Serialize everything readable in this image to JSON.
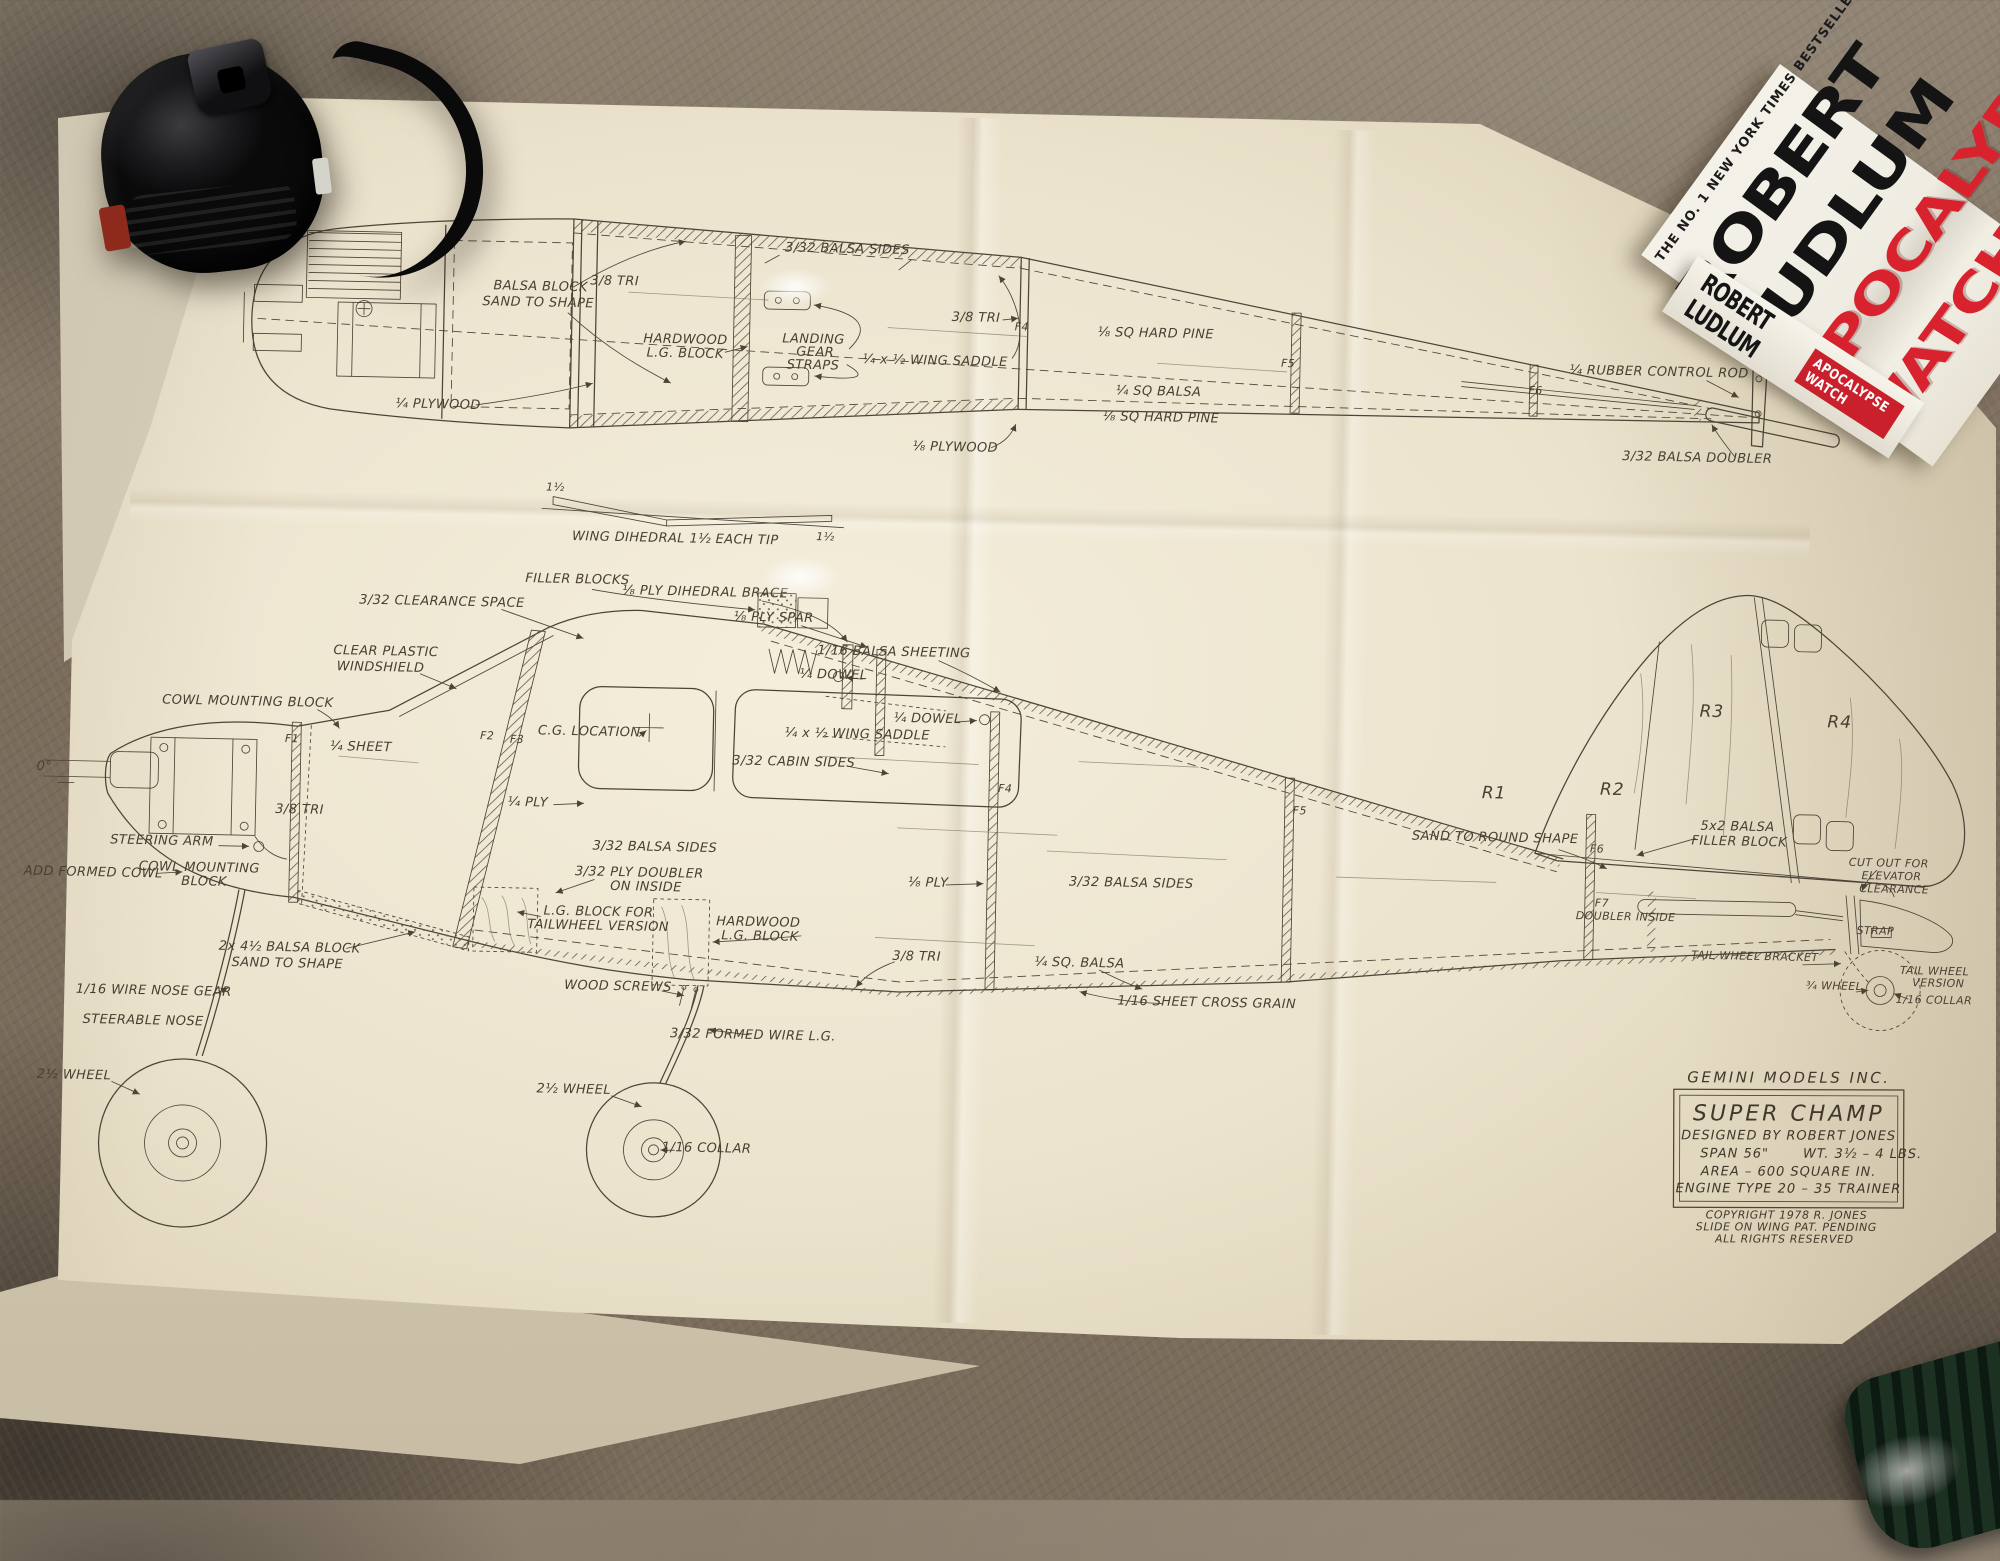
{
  "palette": {
    "carpet": "#7a6c5b",
    "paper": "#ece3cd",
    "ink": "#4d4437",
    "book_red": "#d8232f",
    "book_black": "#141414",
    "tape_black": "#111113",
    "green_object": "#16271c"
  },
  "book": {
    "banner": "THE NO. 1 NEW YORK TIMES BESTSELLER",
    "author_line1": "ROBERT",
    "author_line2": "LUDLUM",
    "title_line1": "APOCALYPSE",
    "title_line2": "WATCH",
    "spine_author": "ROBERT LUDLUM",
    "spine_title": "APOCALYPSE WATCH"
  },
  "title_block": {
    "company": "GEMINI MODELS INC.",
    "model": "SUPER CHAMP",
    "designer": "DESIGNED BY ROBERT JONES",
    "span": "SPAN 56\"",
    "weight": "WT. 3½ – 4 LBS.",
    "area": "AREA – 600 SQUARE IN.",
    "engine": "ENGINE TYPE 20 – 35 TRAINER",
    "copyright_line1": "COPYRIGHT 1978 R. JONES",
    "copyright_line2": "SLIDE ON WING PAT. PENDING",
    "copyright_line3": "ALL RIGHTS RESERVED"
  },
  "dihedral": {
    "caption": "WING DIHEDRAL 1½ EACH TIP",
    "tip_left": "1½",
    "tip_right": "1½"
  },
  "top_view": {
    "labels": [
      "3/32 BALSA SIDES",
      "BALSA BLOCK",
      "SAND TO SHAPE",
      "3/8 TRI",
      "¼ PLYWOOD",
      "HARDWOOD",
      "L.G. BLOCK",
      "LANDING",
      "GEAR",
      "STRAPS",
      "¼ x ½ WING SADDLE",
      "3/8 TRI",
      "⅛ PLYWOOD",
      "⅛ SQ HARD PINE",
      "¼ SQ BALSA",
      "⅛ SQ HARD PINE",
      "F4",
      "F5",
      "F6",
      "¼ RUBBER CONTROL ROD",
      "3/32 BALSA DOUBLER"
    ]
  },
  "side_view": {
    "labels": [
      "FILLER BLOCKS",
      "⅛ PLY DIHEDRAL BRACE",
      "⅛ PLY SPAR",
      "3/32 CLEARANCE SPACE",
      "CLEAR PLASTIC",
      "WINDSHIELD",
      "C.G. LOCATION",
      "¼ SHEET",
      "3/32 CABIN SIDES",
      "¼ PLY",
      "1/16 BALSA SHEETING",
      "¼ DOWEL",
      "¼ DOWEL",
      "¼ x ½ WING SADDLE",
      "⅛ PLY",
      "3/8 TRI",
      "3/32 BALSA SIDES",
      "¼ SQ. BALSA",
      "1/16 SHEET CROSS GRAIN",
      "3/32 BALSA SIDES",
      "3/32 PLY DOUBLER",
      "ON INSIDE",
      "L.G. BLOCK FOR",
      "TAILWHEEL VERSION",
      "HARDWOOD",
      "L.G. BLOCK",
      "WOOD SCREWS",
      "3/32 FORMED WIRE L.G.",
      "COWL MOUNTING BLOCK",
      "3/8 TRI",
      "STEERING ARM",
      "ADD FORMED COWL",
      "COWL MOUNTING",
      "BLOCK",
      "2x 4½ BALSA BLOCK",
      "SAND TO SHAPE",
      "1/16 WIRE NOSE GEAR",
      "STEERABLE NOSE",
      "0°",
      "2½ WHEEL",
      "2½ WHEEL",
      "1/16 COLLAR",
      "SAND TO ROUND SHAPE",
      "5x2 BALSA",
      "FILLER BLOCK",
      "CUT OUT FOR",
      "ELEVATOR",
      "CLEARANCE",
      "F7",
      "DOUBLER INSIDE",
      "TAIL WHEEL BRACKET",
      "STRAP",
      "¾ WHEEL",
      "TAIL WHEEL",
      "VERSION",
      "1/16 COLLAR",
      "R1",
      "R2",
      "R3",
      "R4",
      "F2",
      "F3",
      "F4",
      "F5",
      "F6",
      "F1"
    ]
  }
}
